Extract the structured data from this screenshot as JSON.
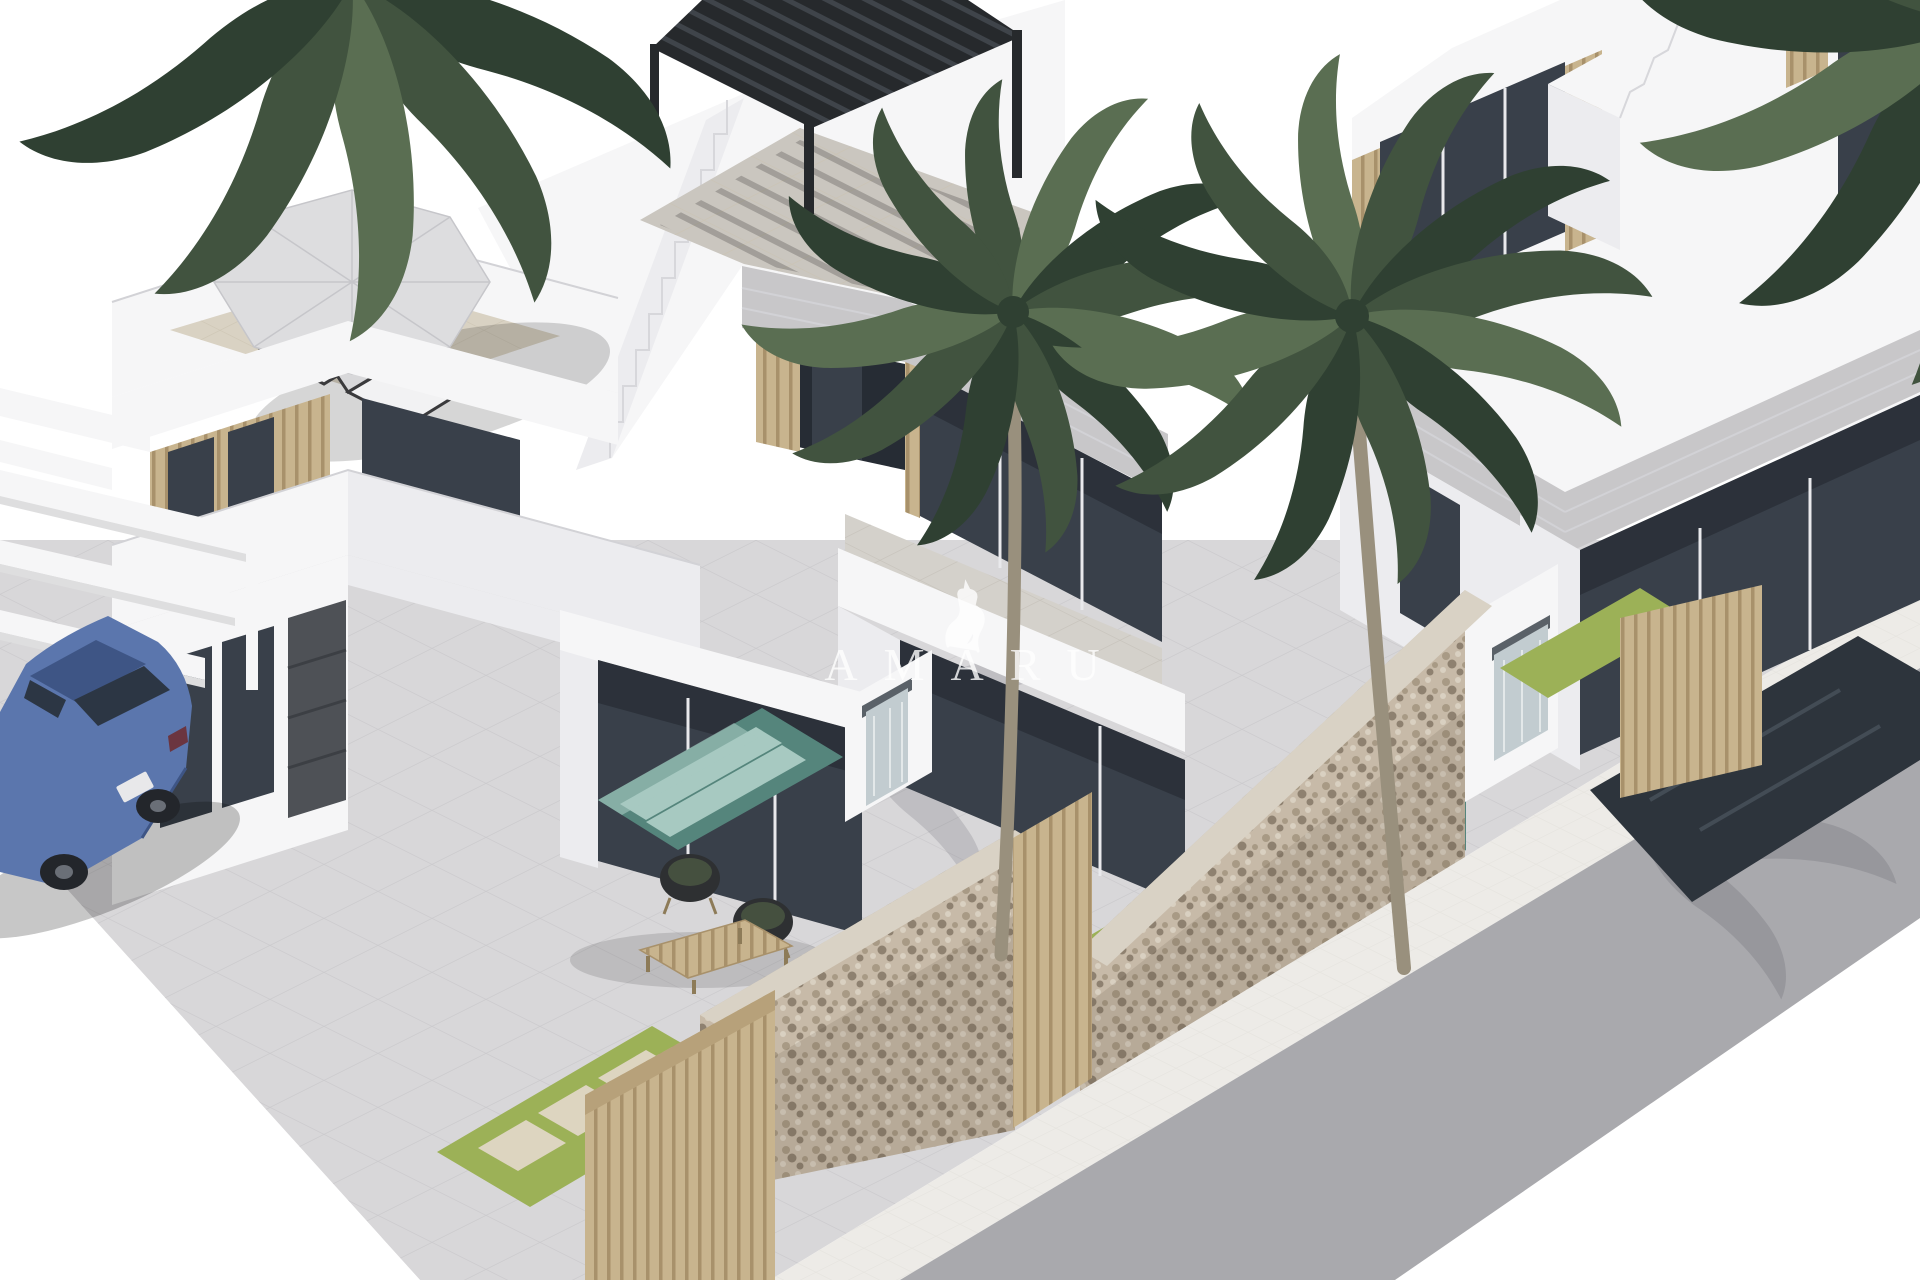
{
  "meta": {
    "type": "architectural-3d-render",
    "description": "Aerial 3D render of a row of modern two-storey white villas with rooftop terraces, plunge pools, palm trees, stone boundary walls, a parked blue sedan and a street at the lower right. Brand watermark in the centre."
  },
  "watermark": {
    "brand": "AMARU",
    "logo": "llama-icon"
  },
  "palette": {
    "bg": "#ffffff",
    "pavement": "#d8d7d9",
    "pavement-line": "#c9c8cb",
    "sidewalk": "#edebe7",
    "road": "#a9a9ad",
    "wall": "#f6f6f7",
    "wall-shade": "#ececef",
    "wall-dark": "#dededf",
    "fascia": "#c8c7c9",
    "roof-floor": "#d9d2c3",
    "terrace": "#d4d1cb",
    "glass": "#39404a",
    "glass-dark": "#262c34",
    "wood": "#c8b48e",
    "wood-dark": "#a8916b",
    "pergola": "#26292c",
    "pergola-slat": "#3f444a",
    "palm": "#41533f",
    "palm-dark": "#2f4032",
    "palm-light": "#5a6e52",
    "trunk": "#99907d",
    "grass": "#9cb157",
    "paver": "#ddd5c0",
    "pool-teal": "#55857c",
    "pool-stripe": "#a7c9c1",
    "pool-dark": "#2d343c",
    "stone": "#c7baa8",
    "stone-speck-1": "#a89a85",
    "stone-speck-2": "#d9d0c1",
    "stone-speck-3": "#8e8170",
    "car-blue": "#5b76ad",
    "car-roof": "#3e5585",
    "car-glass": "#2c3644",
    "wheel": "#23262b",
    "water": "#c2ccd0",
    "watermark": "#ffffff"
  },
  "scene": {
    "objects": [
      "white-villa-left",
      "white-villa-middle",
      "white-villa-right",
      "rooftop-parasol",
      "sun-loungers",
      "rooftop-black-pergola",
      "exterior-staircases",
      "palm-trees",
      "blue-sedan-car",
      "carport-pergola-beams",
      "stone-boundary-walls",
      "wood-slat-gates",
      "teal-plunge-pools",
      "waterfall-water-features",
      "grass-strips-with-pavers",
      "street-and-sidewalk"
    ]
  }
}
